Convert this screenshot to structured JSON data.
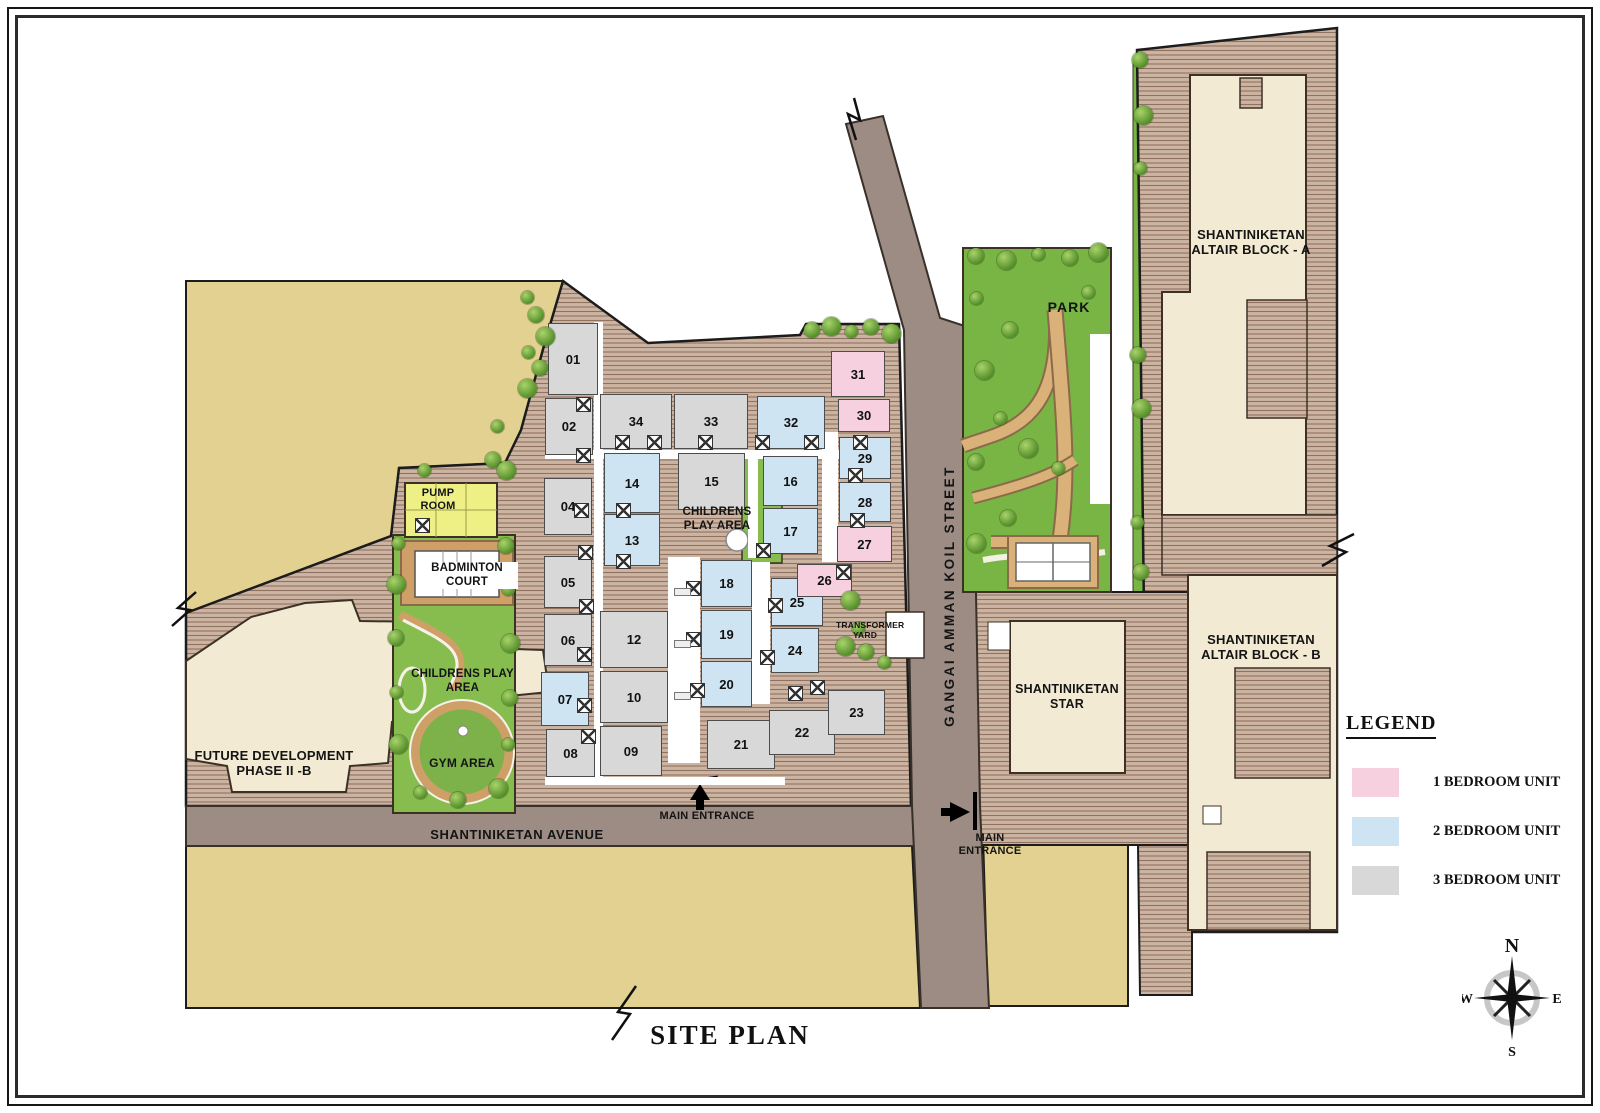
{
  "title": "SITE PLAN",
  "legend": {
    "heading": "LEGEND",
    "items": [
      {
        "label": "1 BEDROOM UNIT",
        "color": "#f7d0e0"
      },
      {
        "label": "2 BEDROOM UNIT",
        "color": "#cfe4f2"
      },
      {
        "label": "3 BEDROOM UNIT",
        "color": "#d8d8d8"
      }
    ]
  },
  "compass": {
    "north": "N",
    "east": "E",
    "south": "S",
    "west": "W"
  },
  "streets": {
    "avenue": "SHANTINIKETAN AVENUE",
    "koil": "GANGAI AMMAN KOIL STREET"
  },
  "entrances": {
    "bottom": "MAIN ENTRANCE",
    "east": "MAIN ENTRANCE"
  },
  "buildings": {
    "block_a": "SHANTINIKETAN ALTAIR BLOCK - A",
    "block_b": "SHANTINIKETAN ALTAIR BLOCK - B",
    "star": "SHANTINIKETAN STAR",
    "future": "FUTURE DEVELOPMENT PHASE II -B"
  },
  "amenities": {
    "park": "PARK",
    "pump_room": "PUMP ROOM",
    "badminton": "BADMINTON COURT",
    "play_area_west": "CHILDRENS PLAY AREA",
    "play_area_center": "CHILDRENS PLAY AREA",
    "gym": "GYM AREA",
    "transformer": "TRANSFORMER YARD"
  },
  "unit_type_colors": {
    "1": "#f7d0e0",
    "2": "#cfe4f2",
    "3": "#d8d8d8"
  },
  "units": [
    {
      "no": "01",
      "bed": "3",
      "x": 548,
      "y": 323,
      "w": 50,
      "h": 72
    },
    {
      "no": "02",
      "bed": "3",
      "x": 545,
      "y": 398,
      "w": 48,
      "h": 57
    },
    {
      "no": "04",
      "bed": "3",
      "x": 544,
      "y": 478,
      "w": 48,
      "h": 57
    },
    {
      "no": "05",
      "bed": "3",
      "x": 544,
      "y": 556,
      "w": 48,
      "h": 52
    },
    {
      "no": "06",
      "bed": "3",
      "x": 544,
      "y": 614,
      "w": 48,
      "h": 52
    },
    {
      "no": "07",
      "bed": "2",
      "x": 541,
      "y": 672,
      "w": 48,
      "h": 54
    },
    {
      "no": "08",
      "bed": "3",
      "x": 546,
      "y": 729,
      "w": 49,
      "h": 48
    },
    {
      "no": "34",
      "bed": "3",
      "x": 600,
      "y": 394,
      "w": 72,
      "h": 55
    },
    {
      "no": "14",
      "bed": "2",
      "x": 604,
      "y": 453,
      "w": 56,
      "h": 60
    },
    {
      "no": "13",
      "bed": "2",
      "x": 604,
      "y": 514,
      "w": 56,
      "h": 52
    },
    {
      "no": "12",
      "bed": "3",
      "x": 600,
      "y": 611,
      "w": 68,
      "h": 57
    },
    {
      "no": "10",
      "bed": "3",
      "x": 600,
      "y": 671,
      "w": 68,
      "h": 52
    },
    {
      "no": "09",
      "bed": "3",
      "x": 600,
      "y": 726,
      "w": 62,
      "h": 50
    },
    {
      "no": "33",
      "bed": "3",
      "x": 674,
      "y": 394,
      "w": 74,
      "h": 55
    },
    {
      "no": "15",
      "bed": "3",
      "x": 678,
      "y": 453,
      "w": 67,
      "h": 57
    },
    {
      "no": "18",
      "bed": "2",
      "x": 701,
      "y": 560,
      "w": 51,
      "h": 47
    },
    {
      "no": "19",
      "bed": "2",
      "x": 701,
      "y": 610,
      "w": 51,
      "h": 49
    },
    {
      "no": "20",
      "bed": "2",
      "x": 701,
      "y": 661,
      "w": 51,
      "h": 46
    },
    {
      "no": "21",
      "bed": "3",
      "x": 707,
      "y": 720,
      "w": 68,
      "h": 49
    },
    {
      "no": "32",
      "bed": "2",
      "x": 757,
      "y": 396,
      "w": 68,
      "h": 53
    },
    {
      "no": "16",
      "bed": "2",
      "x": 763,
      "y": 456,
      "w": 55,
      "h": 50
    },
    {
      "no": "17",
      "bed": "2",
      "x": 763,
      "y": 508,
      "w": 55,
      "h": 46
    },
    {
      "no": "25",
      "bed": "2",
      "x": 771,
      "y": 578,
      "w": 52,
      "h": 48
    },
    {
      "no": "24",
      "bed": "2",
      "x": 771,
      "y": 628,
      "w": 48,
      "h": 45
    },
    {
      "no": "22",
      "bed": "3",
      "x": 769,
      "y": 710,
      "w": 66,
      "h": 45
    },
    {
      "no": "23",
      "bed": "3",
      "x": 828,
      "y": 690,
      "w": 57,
      "h": 45
    },
    {
      "no": "31",
      "bed": "1",
      "x": 831,
      "y": 351,
      "w": 54,
      "h": 46
    },
    {
      "no": "30",
      "bed": "1",
      "x": 838,
      "y": 399,
      "w": 52,
      "h": 33
    },
    {
      "no": "29",
      "bed": "2",
      "x": 839,
      "y": 437,
      "w": 52,
      "h": 42
    },
    {
      "no": "28",
      "bed": "2",
      "x": 839,
      "y": 482,
      "w": 52,
      "h": 40
    },
    {
      "no": "27",
      "bed": "1",
      "x": 837,
      "y": 526,
      "w": 55,
      "h": 36
    },
    {
      "no": "26",
      "bed": "1",
      "x": 797,
      "y": 564,
      "w": 55,
      "h": 33
    }
  ],
  "decor": {
    "corridors": [
      [
        594,
        322,
        9,
        458
      ],
      [
        545,
        450,
        345,
        9
      ],
      [
        668,
        557,
        32,
        206
      ],
      [
        748,
        452,
        10,
        106
      ],
      [
        822,
        432,
        16,
        130
      ],
      [
        752,
        562,
        18,
        142
      ],
      [
        545,
        777,
        240,
        8
      ]
    ],
    "stairs": [
      [
        576,
        397
      ],
      [
        576,
        448
      ],
      [
        574,
        503
      ],
      [
        578,
        545
      ],
      [
        579,
        599
      ],
      [
        577,
        647
      ],
      [
        577,
        698
      ],
      [
        581,
        729
      ],
      [
        615,
        435
      ],
      [
        647,
        435
      ],
      [
        698,
        435
      ],
      [
        755,
        435
      ],
      [
        804,
        435
      ],
      [
        853,
        435
      ],
      [
        616,
        503
      ],
      [
        616,
        554
      ],
      [
        686,
        581
      ],
      [
        686,
        632
      ],
      [
        690,
        683
      ],
      [
        756,
        543
      ],
      [
        768,
        598
      ],
      [
        760,
        650
      ],
      [
        788,
        686
      ],
      [
        848,
        468
      ],
      [
        850,
        513
      ],
      [
        836,
        565
      ],
      [
        810,
        680
      ],
      [
        415,
        518
      ]
    ],
    "dashes": [
      [
        674,
        588
      ],
      [
        674,
        640
      ],
      [
        674,
        692
      ]
    ],
    "trees": [
      [
        527,
        297
      ],
      [
        536,
        315
      ],
      [
        545,
        336
      ],
      [
        528,
        352
      ],
      [
        540,
        368
      ],
      [
        527,
        388
      ],
      [
        497,
        426
      ],
      [
        493,
        460
      ],
      [
        506,
        470
      ],
      [
        424,
        470
      ],
      [
        812,
        330
      ],
      [
        831,
        326
      ],
      [
        851,
        331
      ],
      [
        871,
        327
      ],
      [
        891,
        333
      ],
      [
        398,
        543
      ],
      [
        506,
        546
      ],
      [
        396,
        584
      ],
      [
        508,
        589
      ],
      [
        396,
        638
      ],
      [
        510,
        643
      ],
      [
        396,
        692
      ],
      [
        510,
        698
      ],
      [
        398,
        744
      ],
      [
        420,
        792
      ],
      [
        458,
        800
      ],
      [
        498,
        788
      ],
      [
        508,
        744
      ],
      [
        976,
        256
      ],
      [
        1006,
        260
      ],
      [
        1038,
        254
      ],
      [
        1070,
        258
      ],
      [
        1098,
        252
      ],
      [
        976,
        298
      ],
      [
        1010,
        330
      ],
      [
        984,
        370
      ],
      [
        1000,
        418
      ],
      [
        976,
        462
      ],
      [
        1028,
        448
      ],
      [
        1058,
        468
      ],
      [
        1008,
        518
      ],
      [
        976,
        543
      ],
      [
        1088,
        292
      ],
      [
        1140,
        60
      ],
      [
        1143,
        115
      ],
      [
        1140,
        168
      ],
      [
        1138,
        355
      ],
      [
        1141,
        408
      ],
      [
        1137,
        522
      ],
      [
        1141,
        572
      ],
      [
        850,
        600
      ],
      [
        858,
        628
      ],
      [
        866,
        652
      ],
      [
        845,
        646
      ],
      [
        884,
        662
      ]
    ]
  }
}
